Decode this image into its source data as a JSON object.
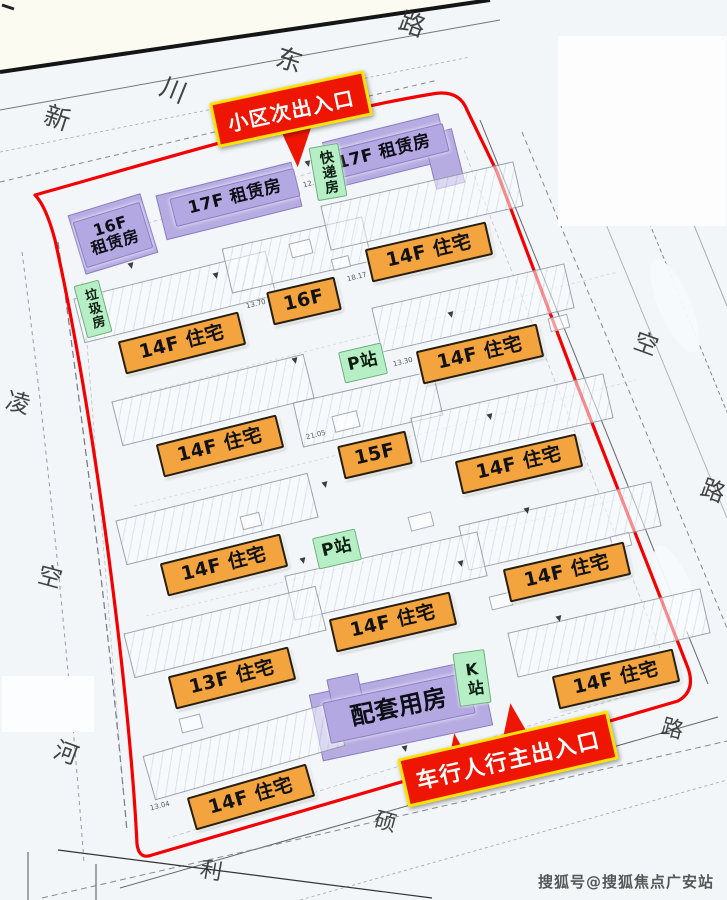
{
  "watermark": "搜狐号@搜狐焦点广安站",
  "marker_glyph": "▼",
  "colors": {
    "boundary": "#f40000",
    "banner_bg": "#ee1602",
    "banner_border": "#ffe10a",
    "residential_label": "#f3a43e",
    "rental_label": "#b3a8e2",
    "station_label": "#b6eec6",
    "road_line": "#1c1c1c",
    "map_background": "#f2f6f9",
    "outer_background": "#fbfbf1",
    "watermark_color": "#4a4a4a"
  },
  "entrance_banners": [
    {
      "label": "小区次出入口",
      "x": 212,
      "y": 86,
      "w": 152,
      "h": 40,
      "rot": -12,
      "pointer": "down"
    },
    {
      "label": "车行人行主出入口",
      "x": 400,
      "y": 734,
      "w": 210,
      "h": 44,
      "rot": -13,
      "pointer": "up"
    }
  ],
  "road_labels": [
    {
      "t": "新",
      "x": 44,
      "y": 106,
      "s": 26,
      "r": 18
    },
    {
      "t": "川",
      "x": 160,
      "y": 78,
      "s": 26,
      "r": 22
    },
    {
      "t": "东",
      "x": 276,
      "y": 48,
      "s": 26,
      "r": 18
    },
    {
      "t": "路",
      "x": 399,
      "y": 12,
      "s": 26,
      "r": 20
    },
    {
      "t": "凌",
      "x": 6,
      "y": 391,
      "s": 24,
      "r": 15
    },
    {
      "t": "空",
      "x": 38,
      "y": 565,
      "s": 24,
      "r": 15
    },
    {
      "t": "河",
      "x": 54,
      "y": 741,
      "s": 24,
      "r": 20
    },
    {
      "t": "空",
      "x": 634,
      "y": 332,
      "s": 24,
      "r": 20
    },
    {
      "t": "路",
      "x": 701,
      "y": 479,
      "s": 24,
      "r": 20
    },
    {
      "t": "路",
      "x": 661,
      "y": 719,
      "s": 22,
      "r": 15
    },
    {
      "t": "硕",
      "x": 374,
      "y": 812,
      "s": 22,
      "r": 15
    },
    {
      "t": "利",
      "x": 200,
      "y": 861,
      "s": 22,
      "r": 10
    }
  ],
  "rental_shapes": [
    {
      "x": 228,
      "y": 200,
      "w": 138,
      "h": 44,
      "rot": -14
    },
    {
      "x": 385,
      "y": 150,
      "w": 118,
      "h": 46,
      "rot": -14
    },
    {
      "x": 443,
      "y": 158,
      "w": 28,
      "h": 54,
      "rot": -14
    },
    {
      "x": 112,
      "y": 233,
      "w": 74,
      "h": 60,
      "rot": -17
    },
    {
      "x": 400,
      "y": 709,
      "w": 172,
      "h": 66,
      "rot": -12
    },
    {
      "x": 344,
      "y": 689,
      "w": 30,
      "h": 26,
      "rot": -12
    }
  ],
  "buildings": [
    {
      "label": "17F 租赁房",
      "type": "rental",
      "x": 234,
      "y": 196,
      "w": 126,
      "h": 27,
      "rot": -14,
      "fs": 17
    },
    {
      "label": "17F 租赁房",
      "type": "rental",
      "x": 383,
      "y": 151,
      "w": 126,
      "h": 27,
      "rot": -14,
      "fs": 17
    },
    {
      "lines": [
        "16F",
        "租赁房"
      ],
      "type": "rental",
      "x": 112,
      "y": 234,
      "w": 68,
      "h": 46,
      "rot": -17,
      "fs": 16
    },
    {
      "label": "配套用房",
      "type": "rental",
      "x": 398,
      "y": 707,
      "w": 146,
      "h": 40,
      "rot": -12,
      "fs": 24
    },
    {
      "label": "快递房",
      "type": "station",
      "vertical": true,
      "x": 327,
      "y": 171,
      "w": 28,
      "h": 52,
      "rot": -10,
      "fs": 14
    },
    {
      "label": "垃圾房",
      "type": "station",
      "vertical": true,
      "x": 92,
      "y": 308,
      "w": 24,
      "h": 52,
      "rot": -15,
      "fs": 13
    },
    {
      "label": "P站",
      "type": "station",
      "x": 362,
      "y": 362,
      "w": 42,
      "h": 30,
      "rot": -13,
      "fs": 17
    },
    {
      "label": "P站",
      "type": "station",
      "x": 336,
      "y": 548,
      "w": 42,
      "h": 30,
      "rot": -13,
      "fs": 17
    },
    {
      "label": "K站",
      "type": "station",
      "vertical": true,
      "x": 471,
      "y": 677,
      "w": 30,
      "h": 52,
      "rot": -8,
      "fs": 16
    },
    {
      "label": "14F 住宅",
      "type": "res",
      "x": 180,
      "y": 341,
      "w": 120,
      "h": 30,
      "rot": -14,
      "fs": 19
    },
    {
      "label": "16F",
      "type": "res",
      "x": 302,
      "y": 299,
      "w": 66,
      "h": 30,
      "rot": -13,
      "fs": 19
    },
    {
      "label": "14F 住宅",
      "type": "res",
      "x": 427,
      "y": 250,
      "w": 120,
      "h": 30,
      "rot": -13,
      "fs": 19
    },
    {
      "label": "14F 住宅",
      "type": "res",
      "x": 478,
      "y": 352,
      "w": 120,
      "h": 30,
      "rot": -13,
      "fs": 19
    },
    {
      "label": "14F 住宅",
      "type": "res",
      "x": 218,
      "y": 444,
      "w": 120,
      "h": 30,
      "rot": -14,
      "fs": 19
    },
    {
      "label": "15F",
      "type": "res",
      "x": 373,
      "y": 453,
      "w": 66,
      "h": 30,
      "rot": -13,
      "fs": 19
    },
    {
      "label": "14F 住宅",
      "type": "res",
      "x": 517,
      "y": 462,
      "w": 120,
      "h": 30,
      "rot": -13,
      "fs": 19
    },
    {
      "label": "14F 住宅",
      "type": "res",
      "x": 222,
      "y": 563,
      "w": 120,
      "h": 30,
      "rot": -14,
      "fs": 19
    },
    {
      "label": "14F 住宅",
      "type": "res",
      "x": 565,
      "y": 570,
      "w": 120,
      "h": 30,
      "rot": -13,
      "fs": 19
    },
    {
      "label": "14F 住宅",
      "type": "res",
      "x": 391,
      "y": 620,
      "w": 120,
      "h": 30,
      "rot": -13,
      "fs": 19
    },
    {
      "label": "13F 住宅",
      "type": "res",
      "x": 230,
      "y": 676,
      "w": 120,
      "h": 30,
      "rot": -14,
      "fs": 19
    },
    {
      "label": "14F 住宅",
      "type": "res",
      "x": 614,
      "y": 677,
      "w": 120,
      "h": 30,
      "rot": -13,
      "fs": 19
    },
    {
      "label": "14F 住宅",
      "type": "res",
      "x": 249,
      "y": 795,
      "w": 120,
      "h": 30,
      "rot": -16,
      "fs": 19
    }
  ],
  "dims": [
    {
      "t": "12.35",
      "x": 303,
      "y": 180
    },
    {
      "t": "13.70",
      "x": 246,
      "y": 301
    },
    {
      "t": "18.17",
      "x": 347,
      "y": 274
    },
    {
      "t": "13.30",
      "x": 393,
      "y": 359
    },
    {
      "t": "21.05",
      "x": 306,
      "y": 432
    },
    {
      "t": "13.04",
      "x": 150,
      "y": 803
    }
  ],
  "markers": [
    [
      305,
      160
    ],
    [
      128,
      262
    ],
    [
      213,
      272
    ],
    [
      278,
      296
    ],
    [
      292,
      357
    ],
    [
      322,
      481
    ],
    [
      300,
      557
    ],
    [
      270,
      663
    ],
    [
      402,
      745
    ],
    [
      420,
      606
    ],
    [
      556,
      615
    ],
    [
      524,
      507
    ],
    [
      487,
      413
    ],
    [
      448,
      311
    ],
    [
      575,
      672
    ],
    [
      458,
      560
    ]
  ],
  "decor_rects": [
    [
      300,
      247,
      20,
      13
    ],
    [
      345,
      420,
      24,
      15
    ],
    [
      250,
      520,
      18,
      12
    ],
    [
      420,
      520,
      22,
      13
    ],
    [
      500,
      600,
      20,
      12
    ],
    [
      190,
      722,
      20,
      13
    ],
    [
      558,
      322,
      18,
      12
    ],
    [
      620,
      540,
      18,
      12
    ],
    [
      340,
      262,
      16,
      10
    ],
    [
      470,
      252,
      16,
      10
    ]
  ]
}
